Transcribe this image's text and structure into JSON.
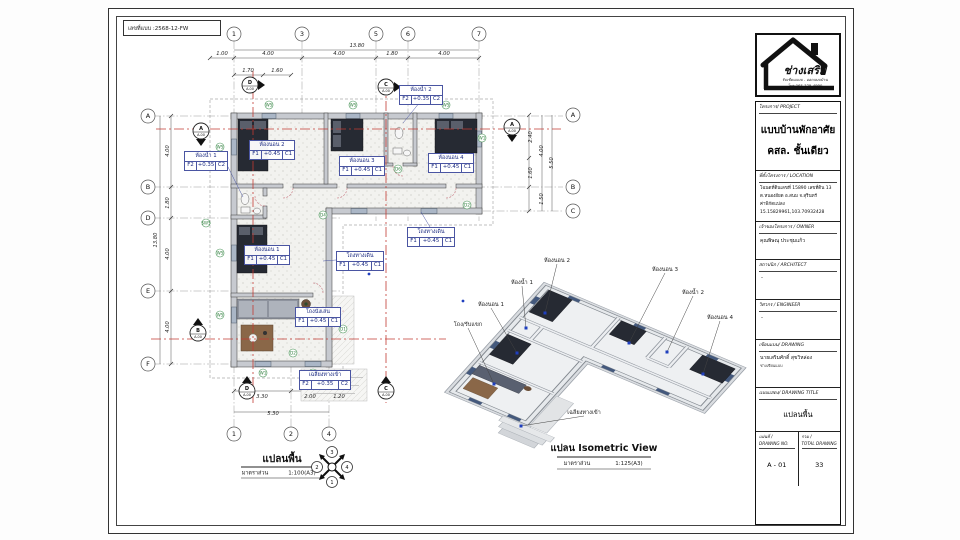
{
  "sheet": {
    "code": "เลขที่แบบ :2568-12-FW"
  },
  "plan": {
    "title": "แปลนพื้น",
    "scale_label": "มาตราส่วน",
    "scale_value": "1:100(A3)",
    "north": [
      "3",
      "2",
      "4",
      "1"
    ],
    "bubbles": [
      {
        "t": "1",
        "x": 233,
        "y": 33
      },
      {
        "t": "3",
        "x": 301,
        "y": 33
      },
      {
        "t": "5",
        "x": 375,
        "y": 33
      },
      {
        "t": "6",
        "x": 407,
        "y": 33
      },
      {
        "t": "7",
        "x": 478,
        "y": 33
      },
      {
        "t": "1",
        "x": 233,
        "y": 433
      },
      {
        "t": "2",
        "x": 290,
        "y": 433
      },
      {
        "t": "4",
        "x": 328,
        "y": 433
      },
      {
        "t": "A",
        "x": 147,
        "y": 115
      },
      {
        "t": "B",
        "x": 147,
        "y": 186
      },
      {
        "t": "D",
        "x": 147,
        "y": 217
      },
      {
        "t": "E",
        "x": 147,
        "y": 290
      },
      {
        "t": "F",
        "x": 147,
        "y": 363
      },
      {
        "t": "A",
        "x": 572,
        "y": 114
      },
      {
        "t": "B",
        "x": 572,
        "y": 186
      },
      {
        "t": "C",
        "x": 572,
        "y": 210
      }
    ],
    "dims": [
      {
        "t": "13.80",
        "x": 356,
        "y": 46
      },
      {
        "t": "1.00",
        "x": 221,
        "y": 54
      },
      {
        "t": "4.00",
        "x": 267,
        "y": 54
      },
      {
        "t": "4.00",
        "x": 338,
        "y": 54
      },
      {
        "t": "1.80",
        "x": 391,
        "y": 54
      },
      {
        "t": "4.00",
        "x": 443,
        "y": 54
      },
      {
        "t": "1.70",
        "x": 247,
        "y": 71
      },
      {
        "t": "1.60",
        "x": 276,
        "y": 71
      },
      {
        "t": "4.00",
        "x": 168,
        "y": 150,
        "r": -90
      },
      {
        "t": "1.80",
        "x": 168,
        "y": 202,
        "r": -90
      },
      {
        "t": "4.00",
        "x": 168,
        "y": 253,
        "r": -90
      },
      {
        "t": "4.00",
        "x": 168,
        "y": 326,
        "r": -90
      },
      {
        "t": "13.80",
        "x": 156,
        "y": 239,
        "r": -90
      },
      {
        "t": "2.40",
        "x": 531,
        "y": 136,
        "r": -90
      },
      {
        "t": "1.60",
        "x": 531,
        "y": 172,
        "r": -90
      },
      {
        "t": "4.00",
        "x": 542,
        "y": 150,
        "r": -90
      },
      {
        "t": "1.50",
        "x": 542,
        "y": 198,
        "r": -90
      },
      {
        "t": "5.50",
        "x": 552,
        "y": 162,
        "r": -90
      },
      {
        "t": "3.30",
        "x": 261,
        "y": 397
      },
      {
        "t": "2.00",
        "x": 309,
        "y": 397
      },
      {
        "t": "1.20",
        "x": 338,
        "y": 397
      },
      {
        "t": "5.30",
        "x": 272,
        "y": 414
      }
    ],
    "tags": [
      {
        "t": "W5",
        "x": 268,
        "y": 104
      },
      {
        "t": "W5",
        "x": 352,
        "y": 104
      },
      {
        "t": "W5",
        "x": 445,
        "y": 104
      },
      {
        "t": "W5",
        "x": 219,
        "y": 146
      },
      {
        "t": "W5",
        "x": 219,
        "y": 252
      },
      {
        "t": "W5",
        "x": 219,
        "y": 314
      },
      {
        "t": "W1",
        "x": 481,
        "y": 137
      },
      {
        "t": "W1",
        "x": 262,
        "y": 372
      },
      {
        "t": "W1",
        "x": 312,
        "y": 372
      },
      {
        "t": "SW5",
        "x": 205,
        "y": 222
      },
      {
        "t": "D6",
        "x": 397,
        "y": 168
      },
      {
        "t": "D4",
        "x": 322,
        "y": 214
      },
      {
        "t": "D1",
        "x": 342,
        "y": 328
      },
      {
        "t": "D2",
        "x": 292,
        "y": 352
      },
      {
        "t": "D2",
        "x": 466,
        "y": 204
      }
    ],
    "sections": [
      {
        "t": "D",
        "s": "A-00",
        "x": 249,
        "y": 84,
        "d": "r"
      },
      {
        "t": "C",
        "s": "A-00",
        "x": 385,
        "y": 86,
        "d": "r"
      },
      {
        "t": "A",
        "s": "A-00",
        "x": 200,
        "y": 130,
        "d": "d"
      },
      {
        "t": "A",
        "s": "A-00",
        "x": 511,
        "y": 126,
        "d": "d"
      },
      {
        "t": "B",
        "s": "A-00",
        "x": 197,
        "y": 332,
        "d": "u"
      },
      {
        "t": "D",
        "s": "A-00",
        "x": 246,
        "y": 390,
        "d": "u"
      },
      {
        "t": "C",
        "s": "A-00",
        "x": 385,
        "y": 390,
        "d": "u"
      }
    ],
    "rooms": [
      {
        "n": "ห้องน้ำ 1",
        "f": "F2",
        "lv": "+0.35",
        "c": "C2",
        "x": 183,
        "y": 150,
        "w": 42
      },
      {
        "n": "ห้องนอน 2",
        "f": "F1",
        "lv": "+0.45",
        "c": "C1",
        "x": 248,
        "y": 139,
        "w": 44
      },
      {
        "n": "ห้องนอน 3",
        "f": "F1",
        "lv": "+0.45",
        "c": "C1",
        "x": 338,
        "y": 155,
        "w": 44
      },
      {
        "n": "ห้องน้ำ 2",
        "f": "F2",
        "lv": "+0.35",
        "c": "C2",
        "x": 398,
        "y": 84,
        "w": 42
      },
      {
        "n": "ห้องนอน 4",
        "f": "F1",
        "lv": "+0.45",
        "c": "C1",
        "x": 427,
        "y": 152,
        "w": 44
      },
      {
        "n": "โถงทางเดิน",
        "f": "F1",
        "lv": "+0.45",
        "c": "C1",
        "x": 406,
        "y": 226,
        "w": 46
      },
      {
        "n": "ห้องนอน 1",
        "f": "F1",
        "lv": "+0.45",
        "c": "C1",
        "x": 243,
        "y": 244,
        "w": 44
      },
      {
        "n": "โถงทางเดิน",
        "f": "F1",
        "lv": "+0.45",
        "c": "C1",
        "x": 335,
        "y": 250,
        "w": 46
      },
      {
        "n": "โถงนั่งเล่น",
        "f": "F1",
        "lv": "+0.45",
        "c": "C1",
        "x": 294,
        "y": 306,
        "w": 44
      },
      {
        "n": "เฉลียงทางเข้า",
        "f": "F2",
        "lv": "+0.35",
        "c": "C2",
        "x": 298,
        "y": 369,
        "w": 50
      }
    ]
  },
  "iso": {
    "title": "แปลน Isometric View",
    "scale_label": "มาตราส่วน",
    "scale_value": "1:125(A3)",
    "labels": [
      {
        "t": "ห้องนอน 2",
        "tx": 556,
        "ty": 261,
        "dx": 544,
        "dy": 312
      },
      {
        "t": "ห้องน้ำ 1",
        "tx": 521,
        "ty": 283,
        "dx": 525,
        "dy": 327
      },
      {
        "t": "ห้องนอน 3",
        "tx": 664,
        "ty": 270,
        "dx": 628,
        "dy": 342
      },
      {
        "t": "ห้องน้ำ 2",
        "tx": 692,
        "ty": 293,
        "dx": 666,
        "dy": 351
      },
      {
        "t": "ห้องนอน 1",
        "tx": 490,
        "ty": 305,
        "dx": 516,
        "dy": 352
      },
      {
        "t": "โถง/รับแขก",
        "tx": 467,
        "ty": 325,
        "dx": 493,
        "dy": 383
      },
      {
        "t": "ห้องนอน 4",
        "tx": 719,
        "ty": 318,
        "dx": 702,
        "dy": 373
      },
      {
        "t": "เฉลียงทางเข้า",
        "tx": 583,
        "ty": 413,
        "dx": 520,
        "dy": 425
      }
    ]
  },
  "titleblock": {
    "logo_name": "ช่างเสริม",
    "logo_sub": "รับเขียนแบบ - ออกแบบบ้าน",
    "logo_tel": "โทร.065-329-4990",
    "project_header": "โครงการ/ PROJECT",
    "project_line1": "แบบบ้านพักอาศัย",
    "project_line2": "คสล. ชั้นเดียว",
    "location_header": "ที่ตั้งโครงการ / LOCATION",
    "location_line1": "โฉนดที่ดินเลขที่ 15890 เลขที่ดิน 13",
    "location_line2": "ต.หนองอียด อ.สนม จ.สุรินทร์",
    "location_line3": "ค่าพิกัดแปลง",
    "location_line4": "15.15829961,103.70932428",
    "owner_header": "เจ้าของโครงการ / OWNER",
    "owner_name": "คุณพิษณุ ประชุมแก้ว",
    "architect_header": "สถาปนิก / ARCHITECT",
    "architect_name": "-",
    "engineer_header": "วิศวกร / ENGINEER",
    "engineer_name": "-",
    "drawing_header": "เขียนแบบ/ DRAWING",
    "drawing_name": "นายเสริมศักดิ์ สุขวิหล่อง",
    "drawing_role": "ช่างเขียนแบบ",
    "title_header": "แบบแสดง/ DRAWING TITLE",
    "title_value": "แปลนพื้น",
    "sheetno_header": "แผ่นที่ /",
    "sheetno_sub": "DRAWING NO.",
    "sheetno_value": "A - 01",
    "total_header": "รวม /",
    "total_sub": "TOTAL DRAWING",
    "total_value": "33"
  }
}
